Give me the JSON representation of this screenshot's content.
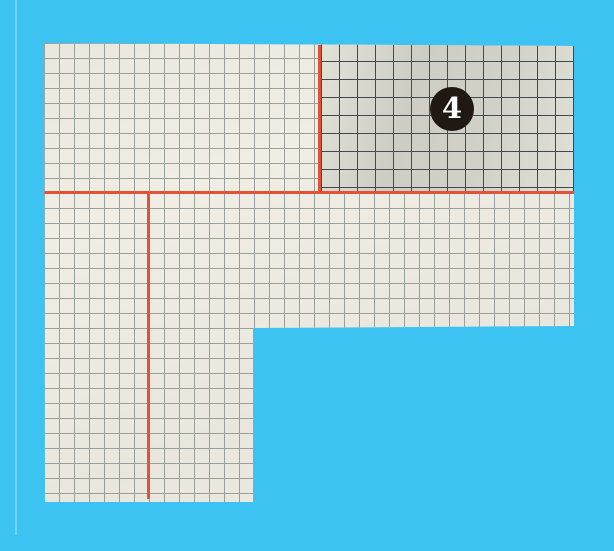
{
  "scene": {
    "description_label": "",
    "step_badge": {
      "label": "4"
    },
    "colors": {
      "bg": "#3cc3f1",
      "paper": "#f0eee4",
      "grid": "#99a29d",
      "grid_dark": "#3a4751",
      "shaded_bg": "#e9e7dc",
      "fold_line": "#e25138",
      "badge_bg": "#201913",
      "badge_text": "#ffffff"
    }
  }
}
